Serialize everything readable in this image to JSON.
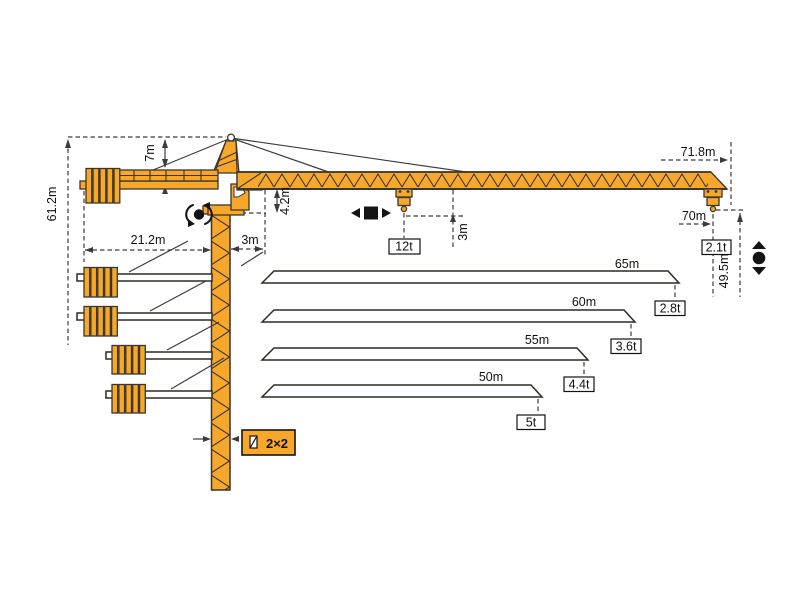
{
  "diagram_type": "tower-crane-dimension-diagram",
  "labels": {
    "total_height": "61.2m",
    "head_height": "7m",
    "counterjib_radius": "21.2m",
    "jib_start_offset": "3m",
    "jib_root_height": "4.2m",
    "max_load": "12t",
    "hook_below_jib": "3m",
    "max_radius": "71.8m",
    "tip_hook_radius": "70m",
    "tip_load": "2.1t",
    "hook_height": "49.5m",
    "mast_section": "2×2"
  },
  "variants": [
    {
      "length": "65m",
      "tip_capacity": "2.8t"
    },
    {
      "length": "60m",
      "tip_capacity": "3.6t"
    },
    {
      "length": "55m",
      "tip_capacity": "4.4t"
    },
    {
      "length": "50m",
      "tip_capacity": "5t"
    }
  ],
  "icons": {
    "slewing": "rotation-symbol",
    "trolley": "trolley-travel-symbol",
    "hoist": "hoisting-symbol"
  },
  "colors": {
    "crane": "#F7A72A",
    "outline": "#3B352B",
    "dimension": "#3C3C3C",
    "text": "#111111"
  }
}
